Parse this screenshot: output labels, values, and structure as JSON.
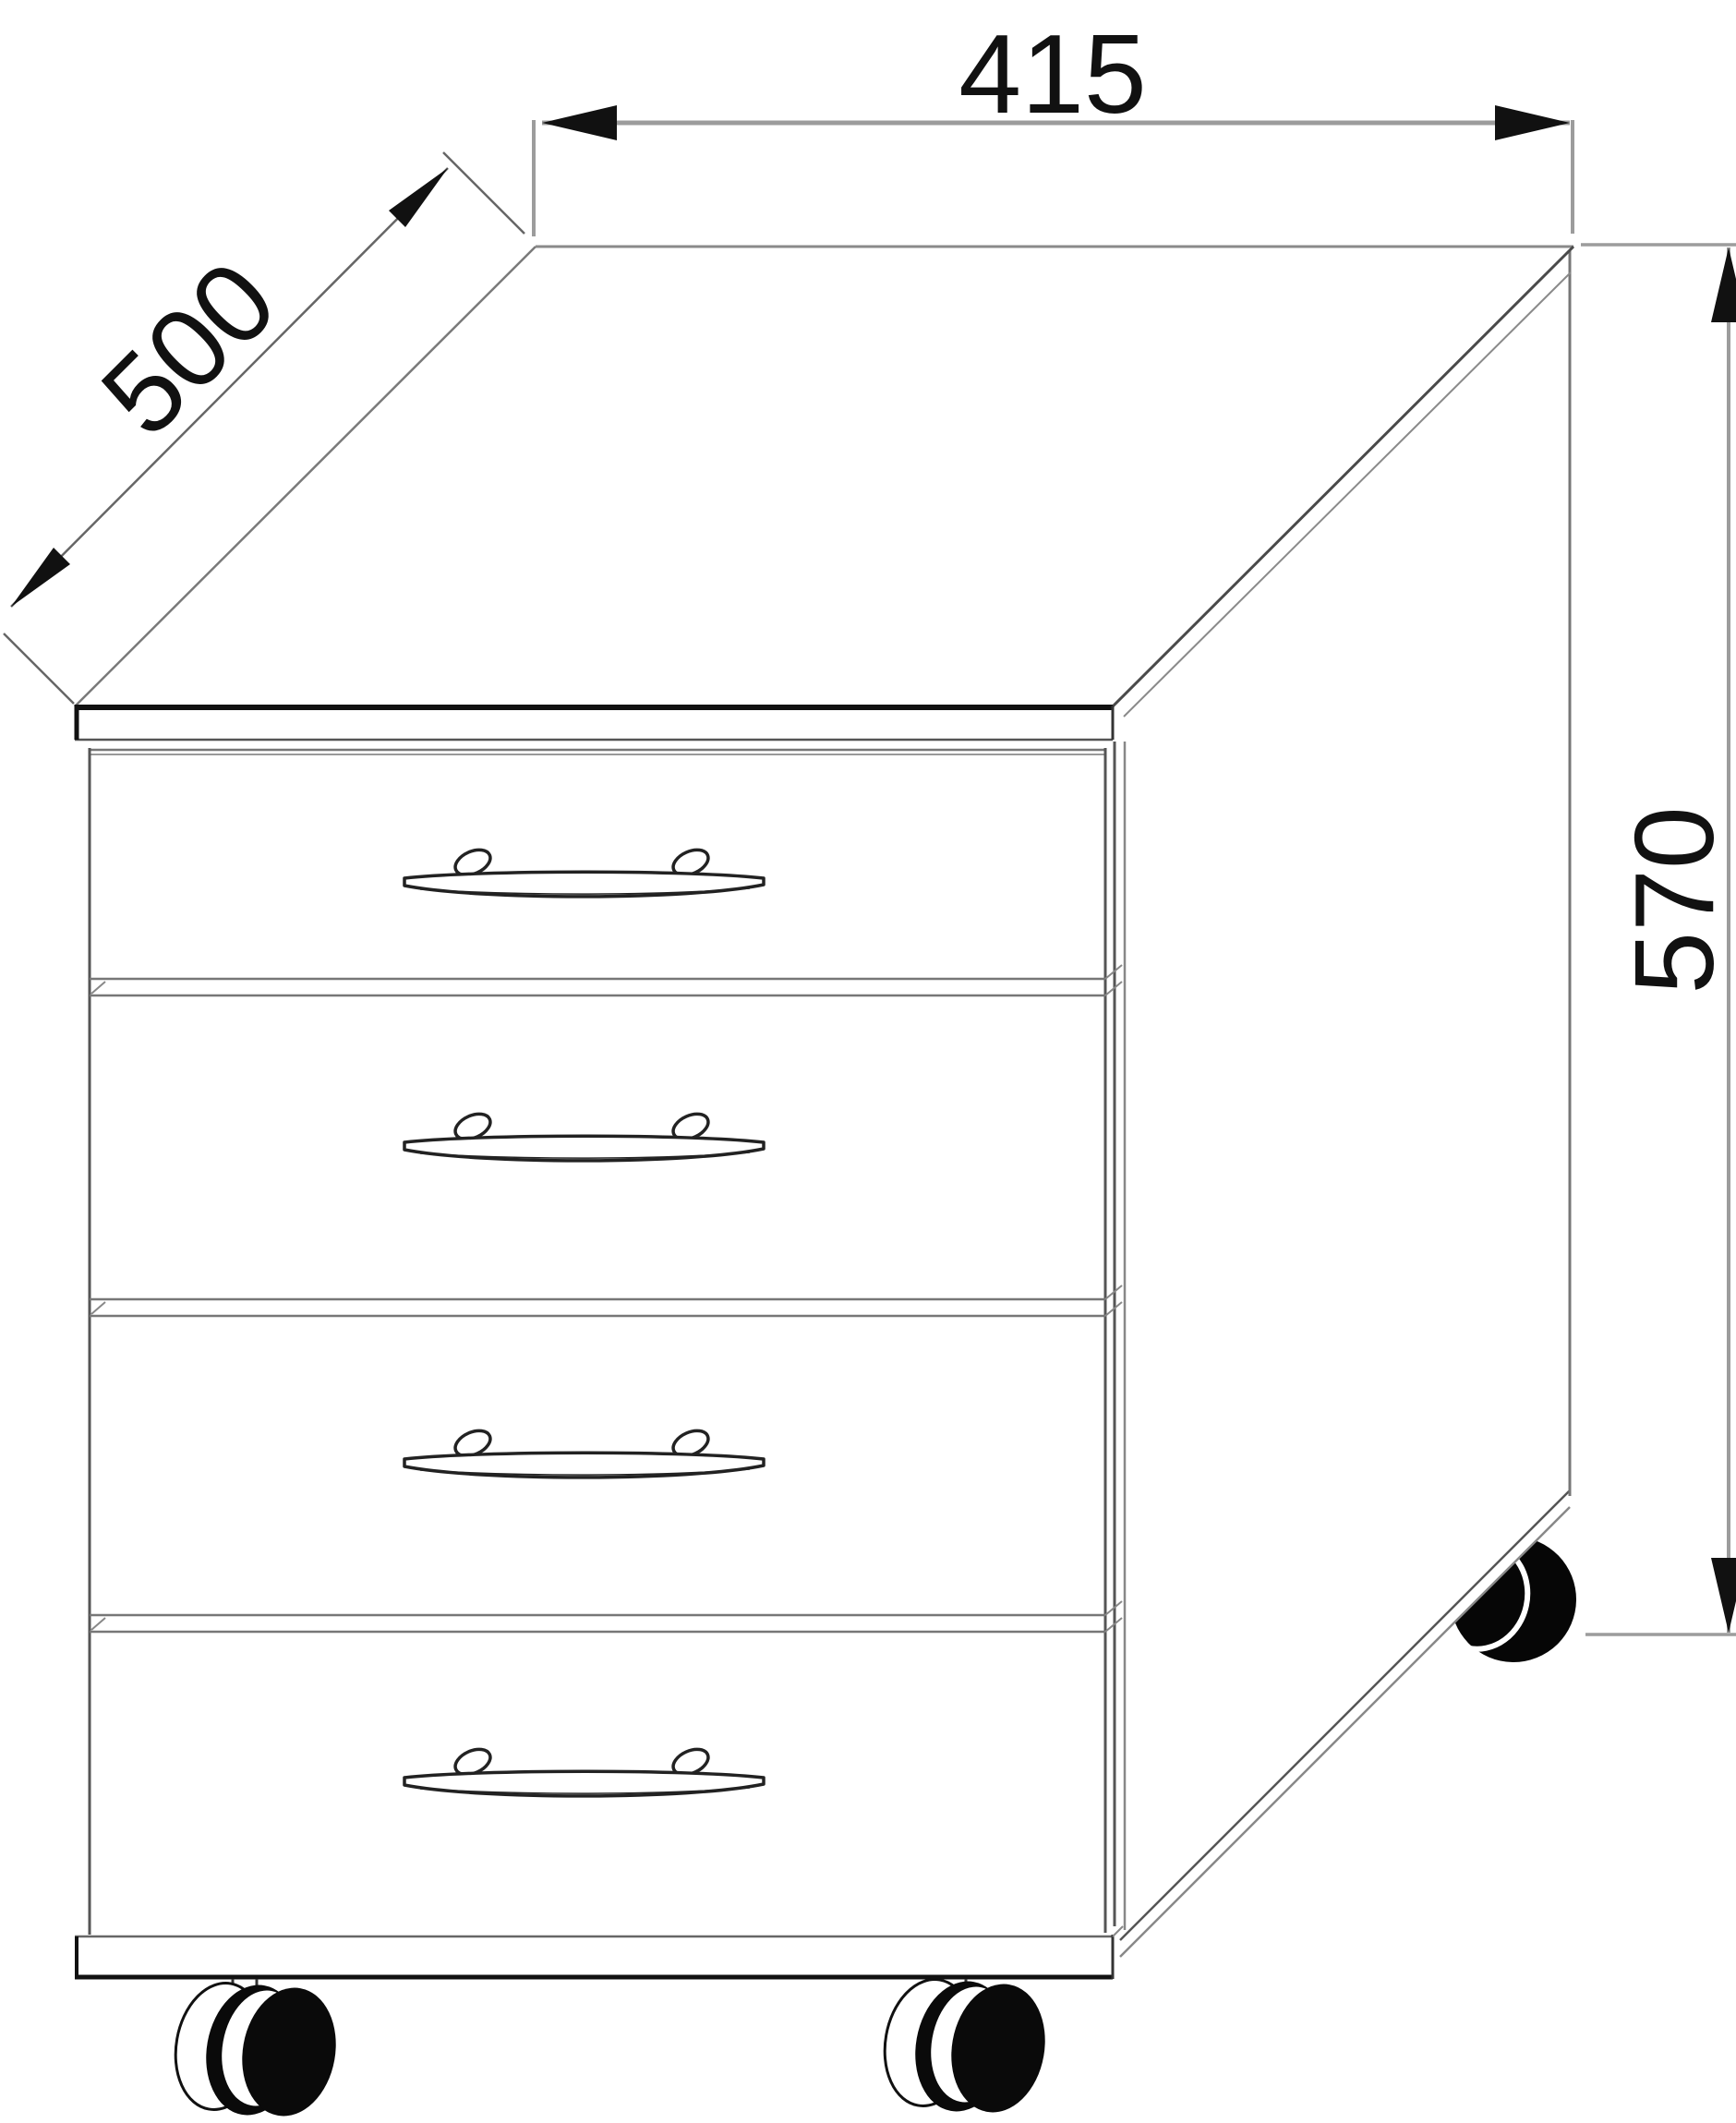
{
  "drawing": {
    "type": "furniture-dimension-diagram",
    "object": "four-drawer mobile pedestal on casters",
    "dimension_width_mm": "415",
    "dimension_depth_mm": "500",
    "dimension_height_mm": "570"
  },
  "cabinet": {
    "drawer_count": 4,
    "handle_count": 4,
    "visible_caster_count": 3
  },
  "style": {
    "background": "#ffffff",
    "line_color": "#1a1a1a",
    "dim_line_color": "#9c9c9c",
    "extension_line_color": "#666666",
    "arrow_color": "#111111",
    "text_color": "#111111"
  }
}
